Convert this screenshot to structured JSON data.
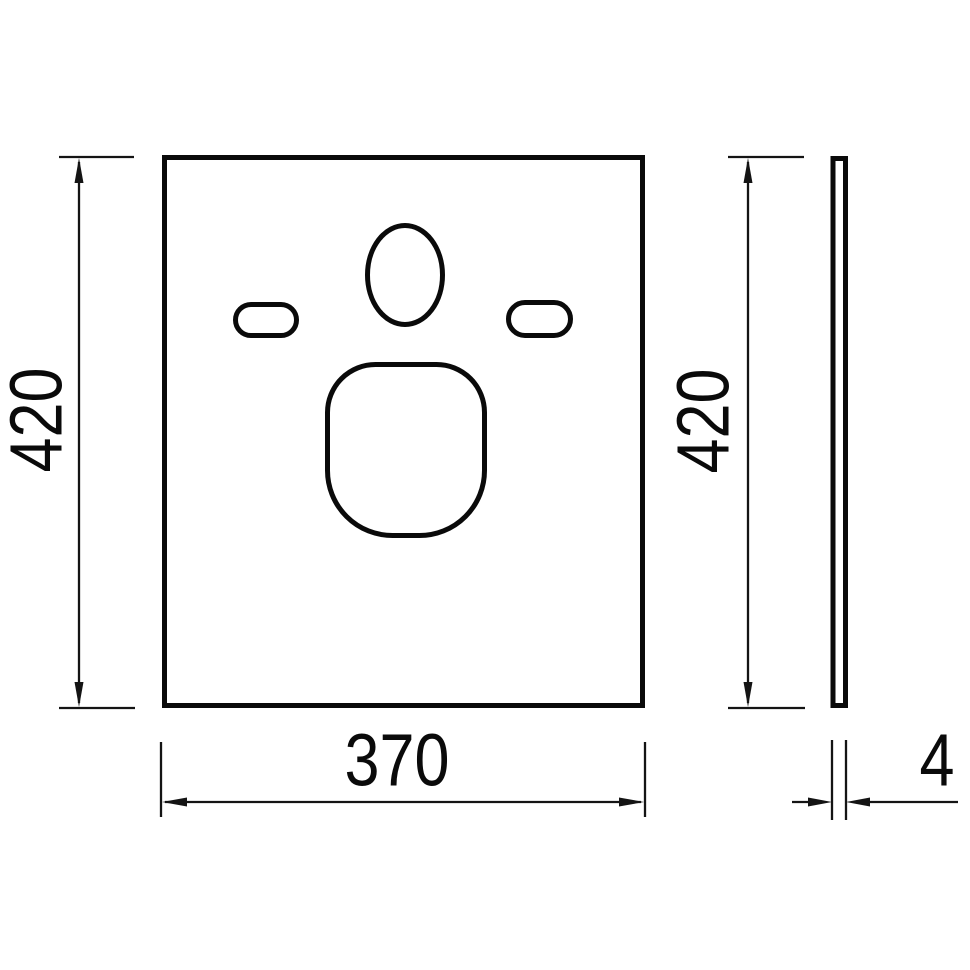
{
  "drawing": {
    "description": "technical-dimension-drawing-front-and-side-view",
    "colors": {
      "line": "#0a0a0a",
      "dimension_line": "#141414",
      "background": "#ffffff"
    },
    "dimensions": {
      "front_height": "420",
      "front_width": "370",
      "side_height": "420",
      "side_thickness": "4"
    }
  }
}
